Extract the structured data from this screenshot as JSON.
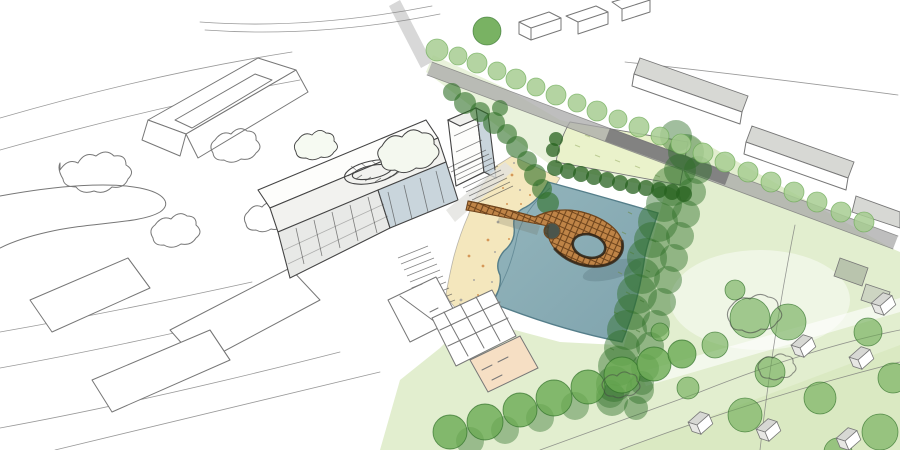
{
  "description": "Hand-drawn aerial architectural concept sketch: a masterplan with a teal pond, sandy beach, a looping timber pier bridge, a mixed-use building block, a sports field, tree rows and context buildings drawn in pen.",
  "palette": {
    "paper": "#ffffff",
    "pen": "#777777",
    "pen_dark": "#444444",
    "water": "#93b5bc",
    "water_deep": "#7fa3ad",
    "water_edge": "#557e8a",
    "beach": "#f4e7bd",
    "beach_speckle": "#cd853f",
    "speckle_gray": "#9a9a9a",
    "lawn": "#e2eecf",
    "lawn_bright": "#d4e6b8",
    "field": "#eaf2cb",
    "tree_dark": "#2e6f27",
    "tree_mid": "#6aaa52",
    "tree_light": "#a7cc92",
    "hedge": "#27621f",
    "wood": "#bf8447",
    "wood_hatch": "#6f451d",
    "wood_dark": "#2f2315",
    "glazing": "#c9d5dc",
    "facade_shade": "#e8e9e7",
    "roof_gray": "#d7d8d4",
    "road": "#a8a8a8",
    "road_dark": "#7c7c7c",
    "road_light": "#d4d4d4",
    "peach": "#f6dfc4"
  },
  "scene": {
    "tree_groups": [
      {
        "name": "street-tree-row",
        "fill": "tree_light",
        "stroke": "tree_mid",
        "sw": 0.8,
        "op": 0.85,
        "trees": [
          [
            437,
            50,
            11
          ],
          [
            458,
            56,
            9
          ],
          [
            477,
            63,
            10
          ],
          [
            497,
            71,
            9
          ],
          [
            516,
            79,
            10
          ],
          [
            536,
            87,
            9
          ],
          [
            556,
            95,
            10
          ],
          [
            577,
            103,
            9
          ],
          [
            597,
            111,
            10
          ],
          [
            618,
            119,
            9
          ],
          [
            639,
            127,
            10
          ],
          [
            660,
            136,
            9
          ],
          [
            681,
            144,
            10
          ],
          [
            703,
            153,
            10
          ],
          [
            725,
            162,
            10
          ],
          [
            748,
            172,
            10
          ],
          [
            771,
            182,
            10
          ],
          [
            794,
            192,
            10
          ],
          [
            817,
            202,
            10
          ],
          [
            841,
            212,
            10
          ],
          [
            864,
            222,
            10
          ]
        ]
      },
      {
        "name": "avenue-accent-tree",
        "fill": "tree_mid",
        "stroke": "tree_dark",
        "sw": 0.8,
        "op": 0.9,
        "trees": [
          [
            487,
            31,
            14
          ]
        ]
      },
      {
        "name": "promenade-trees",
        "fill": "tree_dark",
        "stroke": "",
        "sw": 0,
        "op": 0.6,
        "trees": [
          [
            452,
            92,
            9
          ],
          [
            465,
            103,
            11
          ],
          [
            480,
            112,
            10
          ],
          [
            494,
            123,
            11
          ],
          [
            507,
            134,
            10
          ],
          [
            517,
            147,
            11
          ],
          [
            527,
            161,
            10
          ],
          [
            535,
            175,
            11
          ],
          [
            542,
            189,
            10
          ],
          [
            548,
            203,
            11
          ],
          [
            500,
            108,
            8
          ]
        ]
      },
      {
        "name": "field-hedge",
        "fill": "hedge",
        "stroke": "",
        "sw": 0,
        "op": 0.75,
        "trees": [
          [
            553,
            150,
            7
          ],
          [
            556,
            139,
            7
          ],
          [
            555,
            168,
            8
          ],
          [
            568,
            171,
            8
          ],
          [
            581,
            174,
            8
          ],
          [
            594,
            177,
            8
          ],
          [
            607,
            180,
            8
          ],
          [
            620,
            183,
            8
          ],
          [
            633,
            186,
            8
          ],
          [
            646,
            188,
            8
          ],
          [
            659,
            190,
            8
          ],
          [
            672,
            192,
            8
          ],
          [
            684,
            194,
            8
          ]
        ]
      },
      {
        "name": "pond-tree-band",
        "fill": "tree_dark",
        "stroke": "",
        "sw": 0,
        "op": 0.45,
        "trees": [
          [
            676,
            136,
            16
          ],
          [
            686,
            152,
            18
          ],
          [
            680,
            170,
            16
          ],
          [
            672,
            186,
            20
          ],
          [
            664,
            204,
            18
          ],
          [
            658,
            222,
            20
          ],
          [
            652,
            240,
            18
          ],
          [
            647,
            258,
            20
          ],
          [
            642,
            276,
            18
          ],
          [
            637,
            294,
            20
          ],
          [
            632,
            312,
            18
          ],
          [
            627,
            330,
            20
          ],
          [
            622,
            348,
            18
          ],
          [
            618,
            366,
            20
          ],
          [
            614,
            384,
            18
          ],
          [
            612,
            400,
            16
          ],
          [
            698,
            170,
            14
          ],
          [
            692,
            192,
            14
          ],
          [
            686,
            214,
            14
          ],
          [
            680,
            236,
            14
          ],
          [
            674,
            258,
            14
          ],
          [
            668,
            280,
            14
          ],
          [
            662,
            302,
            14
          ],
          [
            656,
            324,
            14
          ],
          [
            650,
            346,
            14
          ],
          [
            645,
            368,
            14
          ],
          [
            640,
            390,
            14
          ],
          [
            636,
            408,
            12
          ]
        ]
      },
      {
        "name": "bottom-tree-row-back",
        "fill": "tree_dark",
        "stroke": "",
        "sw": 0,
        "op": 0.4,
        "trees": [
          [
            470,
            441,
            14
          ],
          [
            505,
            430,
            14
          ],
          [
            540,
            418,
            14
          ],
          [
            575,
            406,
            14
          ],
          [
            610,
            394,
            14
          ],
          [
            642,
            383,
            12
          ]
        ]
      },
      {
        "name": "bottom-tree-row",
        "fill": "tree_mid",
        "stroke": "tree_dark",
        "sw": 0.9,
        "op": 0.8,
        "trees": [
          [
            450,
            432,
            17
          ],
          [
            485,
            422,
            18
          ],
          [
            520,
            410,
            17
          ],
          [
            554,
            398,
            18
          ],
          [
            588,
            387,
            17
          ],
          [
            622,
            375,
            18
          ],
          [
            654,
            364,
            17
          ],
          [
            682,
            354,
            14
          ]
        ]
      },
      {
        "name": "lawn-trees",
        "fill": "tree_mid",
        "stroke": "tree_dark",
        "sw": 0.8,
        "op": 0.6,
        "trees": [
          [
            750,
            318,
            20
          ],
          [
            788,
            322,
            18
          ],
          [
            715,
            345,
            13
          ],
          [
            770,
            372,
            15
          ],
          [
            820,
            398,
            16
          ],
          [
            745,
            415,
            17
          ],
          [
            688,
            388,
            11
          ],
          [
            868,
            332,
            14
          ],
          [
            893,
            378,
            15
          ],
          [
            880,
            432,
            18
          ],
          [
            838,
            452,
            14
          ],
          [
            735,
            290,
            10
          ],
          [
            660,
            332,
            9
          ]
        ]
      }
    ],
    "beach_speckles": [
      [
        512,
        175
      ],
      [
        520,
        190
      ],
      [
        507,
        204
      ],
      [
        498,
        222
      ],
      [
        509,
        239
      ],
      [
        495,
        252
      ],
      [
        483,
        266
      ],
      [
        492,
        282
      ],
      [
        478,
        295
      ],
      [
        470,
        306
      ],
      [
        503,
        188
      ],
      [
        514,
        221
      ],
      [
        488,
        240
      ],
      [
        474,
        280
      ],
      [
        521,
        204
      ],
      [
        461,
        300
      ],
      [
        504,
        264
      ],
      [
        486,
        214
      ],
      [
        469,
        256
      ],
      [
        514,
        163
      ],
      [
        530,
        195
      ],
      [
        537,
        185
      ]
    ],
    "houses": [
      [
        800,
        348,
        -23
      ],
      [
        858,
        360,
        -23
      ],
      [
        880,
        306,
        -23
      ],
      [
        697,
        425,
        -23
      ],
      [
        765,
        432,
        -23
      ],
      [
        845,
        441,
        -23
      ]
    ]
  }
}
